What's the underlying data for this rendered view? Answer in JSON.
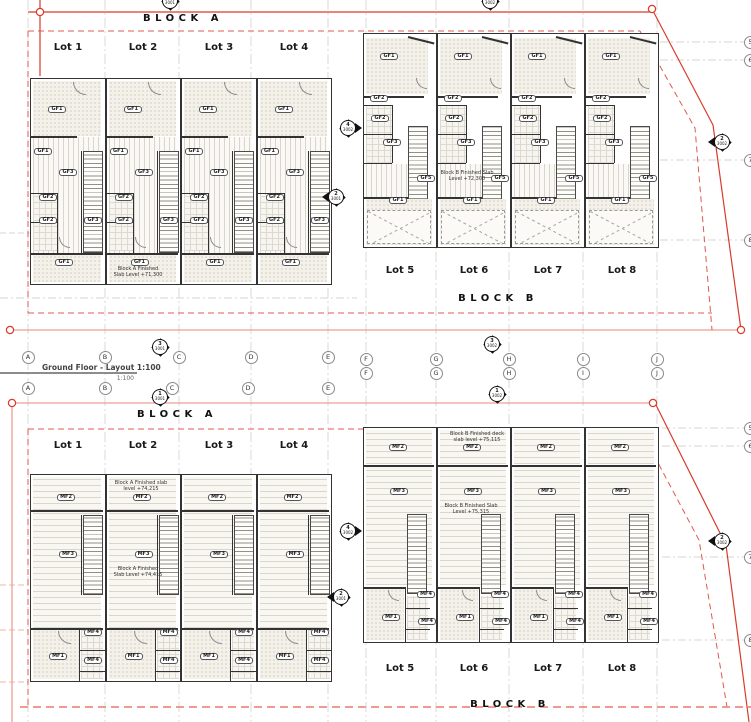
{
  "view": {
    "title": "Ground Floor - Layout 1:100",
    "scale": "1:100"
  },
  "blocks": {
    "block_a_label": "BLOCK A",
    "block_b_label": "BLOCK B"
  },
  "ground_floor": {
    "block_a": {
      "lots": [
        "Lot 1",
        "Lot 2",
        "Lot 3",
        "Lot 4"
      ],
      "slab_note": "Block A Finished\nSlab Level +71,300",
      "room_tags": [
        "GF1",
        "GF1",
        "GF3",
        "GF2",
        "GF2",
        "GF3",
        "GF1"
      ]
    },
    "block_b": {
      "lots": [
        "Lot 5",
        "Lot 6",
        "Lot 7",
        "Lot 8"
      ],
      "slab_note": "Block B Finished Slab\nLevel +72,300",
      "room_tags": [
        "GF1",
        "GF2",
        "GF2",
        "GF3",
        "GF5",
        "GF1"
      ]
    }
  },
  "first_floor": {
    "block_a": {
      "lots": [
        "Lot 1",
        "Lot 2",
        "Lot 3",
        "Lot 4"
      ],
      "deck_note": "Block A Finished slab\nlevel +74,215",
      "slab_note": "Block A Finished\nSlab Level +74,415",
      "room_tags": [
        "MF2",
        "MF3",
        "MF4",
        "MF1",
        "MF4"
      ]
    },
    "block_b": {
      "lots": [
        "Lot 5",
        "Lot 6",
        "Lot 7",
        "Lot 8"
      ],
      "deck_note": "Block B Finished deck\nslab level +75,115",
      "slab_note": "Block B Finished Slab\nLevel +75,315",
      "room_tags": [
        "MF2",
        "MF3",
        "MF4",
        "MF1",
        "MF4"
      ]
    }
  },
  "grid": {
    "letters": [
      "A",
      "B",
      "C",
      "D",
      "E",
      "F",
      "G",
      "H",
      "I",
      "J"
    ],
    "numbers_top": [
      "5",
      "6",
      "7",
      "8"
    ],
    "numbers_bottom": [
      "5",
      "6",
      "7",
      "8"
    ]
  },
  "section_markers": [
    {
      "num": "3",
      "sheet": "3001",
      "x": 170,
      "y": 1,
      "dir": "cut"
    },
    {
      "num": "3",
      "sheet": "3002",
      "x": 490,
      "y": 1,
      "dir": "cut"
    },
    {
      "num": "4",
      "sheet": "3002",
      "x": 348,
      "y": 128,
      "dir": "right"
    },
    {
      "num": "2",
      "sheet": "3001",
      "x": 336,
      "y": 197,
      "dir": "left"
    },
    {
      "num": "2",
      "sheet": "3002",
      "x": 722,
      "y": 142,
      "dir": "left"
    },
    {
      "num": "3",
      "sheet": "3001",
      "x": 160,
      "y": 347,
      "dir": "vert"
    },
    {
      "num": "1",
      "sheet": "3001",
      "x": 160,
      "y": 397,
      "dir": "vert"
    },
    {
      "num": "3",
      "sheet": "3002",
      "x": 492,
      "y": 344,
      "dir": "vert"
    },
    {
      "num": "1",
      "sheet": "3002",
      "x": 497,
      "y": 394,
      "dir": "vert"
    },
    {
      "num": "4",
      "sheet": "3002",
      "x": 348,
      "y": 531,
      "dir": "right"
    },
    {
      "num": "2",
      "sheet": "3001",
      "x": 341,
      "y": 597,
      "dir": "left"
    },
    {
      "num": "2",
      "sheet": "3002",
      "x": 722,
      "y": 541,
      "dir": "left"
    }
  ],
  "colors": {
    "red": "#d93a2b",
    "pink": "#ef9d95",
    "dashed_red": "#e0594e",
    "grid_gray": "#c9c9c9",
    "wall": "#333333"
  }
}
